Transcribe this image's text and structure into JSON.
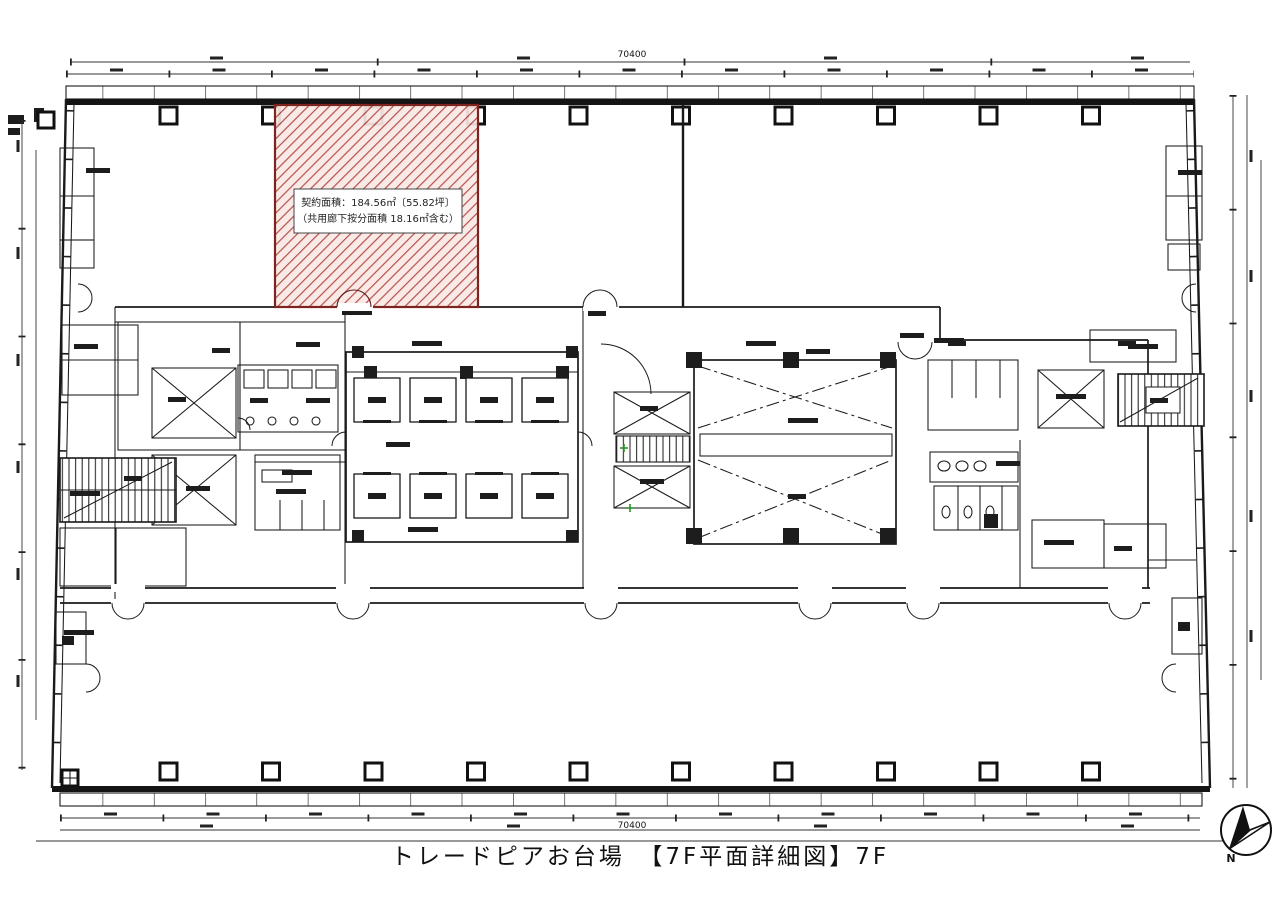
{
  "document": {
    "title": "トレードピアお台場　【7F平面詳細図】7F"
  },
  "floor_plan": {
    "building_name": "トレードピアお台場",
    "floor": "7F",
    "highlighted_area": {
      "label_line1": "契約面積：184.56㎡〔55.82坪〕",
      "label_line2": "（共用廊下按分面積 18.16㎡含む）",
      "contract_area_sqm": "184.56",
      "contract_area_tsubo": "55.82",
      "shared_corridor_sqm": "18.16",
      "hatch_line_color": "#b0423a",
      "hatch_bg_color": "#f8e8e6",
      "border_color": "#7e241f"
    },
    "dimensions": {
      "top_overall": "70400",
      "bottom_overall": "70400"
    },
    "compass": {
      "label": "N"
    },
    "icons": {
      "north_arrow": "compass-north-arrow"
    },
    "line_color": "#1a1a1a"
  }
}
